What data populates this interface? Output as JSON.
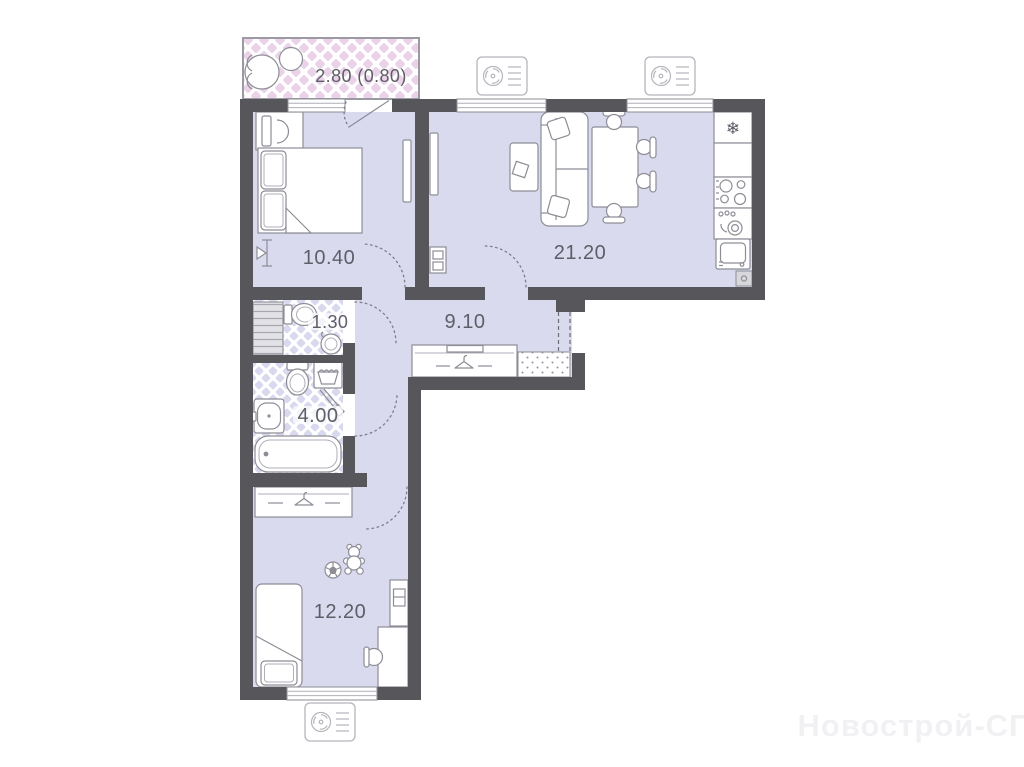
{
  "document": {
    "type": "apartment-floor-plan",
    "style": "2-room flat, L-shaped layout"
  },
  "labels": {
    "balcony": "2.80 (0.80)",
    "bedroom": "10.40",
    "living_kitchen": "21.20",
    "hallway": "9.10",
    "wc": "1.30",
    "bathroom": "4.00",
    "bedroom2": "12.20"
  },
  "icons": {
    "fridge_glyph": "❄",
    "named": [
      "fan-icon",
      "snowflake-fridge-icon",
      "hanger-icon",
      "teddy-bear-icon",
      "soccer-ball-icon",
      "toilet-icon",
      "bathtub-icon",
      "sink-icon",
      "stove-icon",
      "washing-machine-icon",
      "laundry-basket-icon",
      "doormat-icon",
      "floor-lamp-icon"
    ]
  },
  "watermark": "Новострой-СПб",
  "colors": {
    "wall": "#57575b",
    "floor": "#d9daee",
    "balcony_tile": "#ead2e8",
    "bath_tile": "#d8d8ef",
    "furniture_line": "#8d8d96",
    "label_text": "#5e5e68",
    "watermark_text": "#f1f1f4"
  }
}
